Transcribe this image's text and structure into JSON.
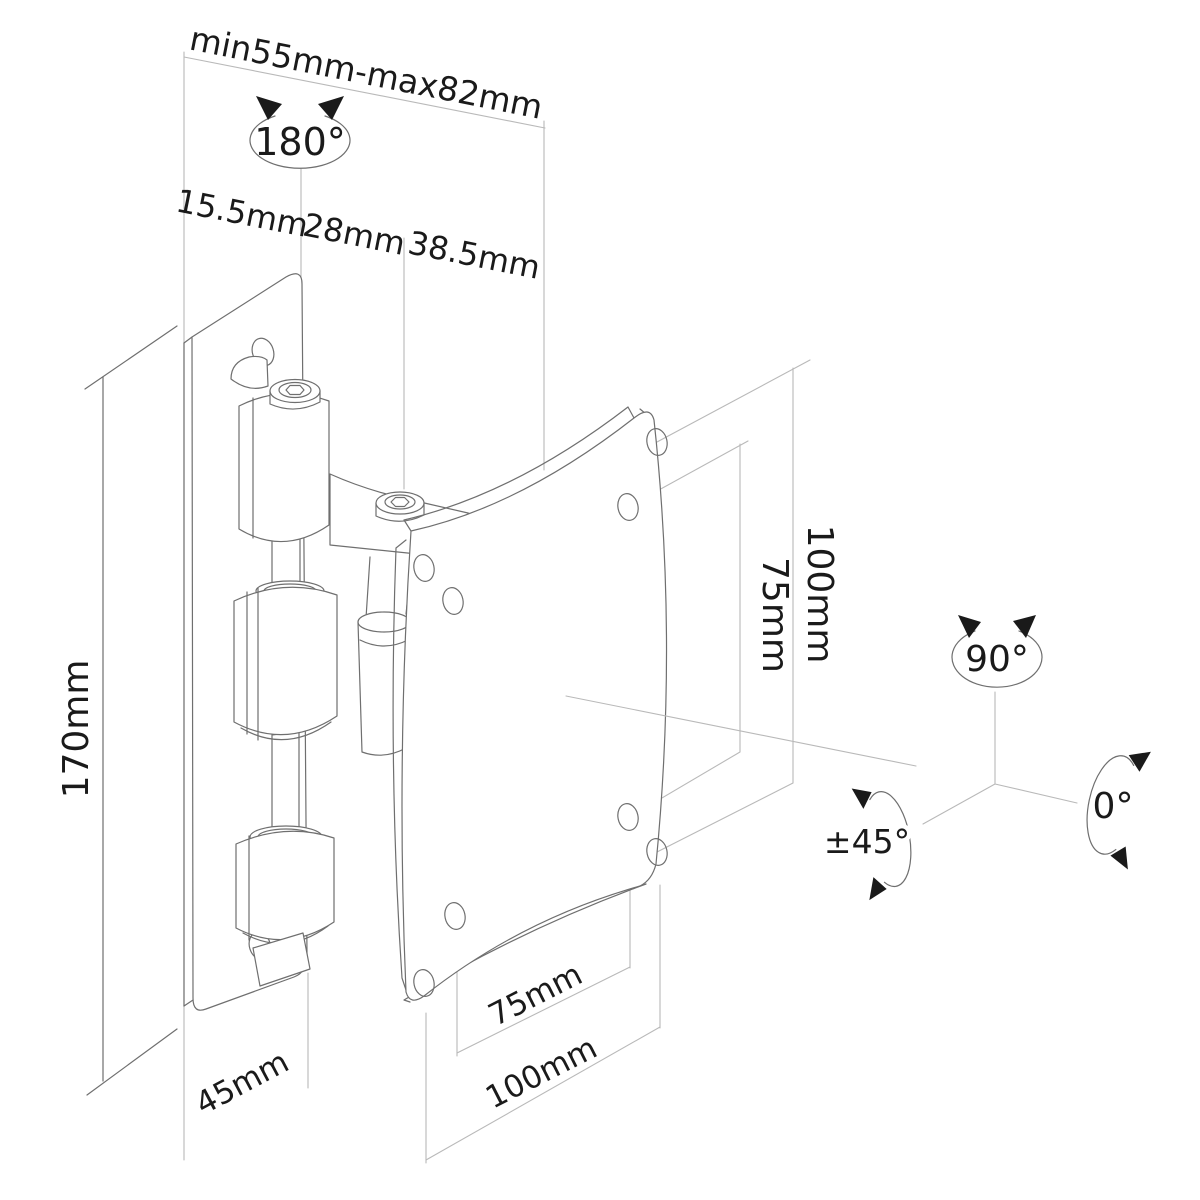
{
  "labels": {
    "depth_range": "min55mm-max82mm",
    "hinge_swivel_angle": "180°",
    "segment_wall_offset": "15.5mm",
    "segment_hinge": "28mm",
    "segment_arm": "38.5mm",
    "wall_plate_height": "170mm",
    "vesa_vertical_inner": "75mm",
    "vesa_vertical_outer": "100mm",
    "wall_plate_width": "45mm",
    "vesa_horizontal_inner": "75mm",
    "vesa_horizontal_outer": "100mm",
    "axis_vertical_angle": "90°",
    "axis_rotation_angle": "0°",
    "axis_tilt_angle": "±45°"
  },
  "colors": {
    "outline": "#6f6f6f",
    "dimension_lines": "#b9b9b9",
    "text": "#1a1a1a",
    "background": "#ffffff"
  }
}
